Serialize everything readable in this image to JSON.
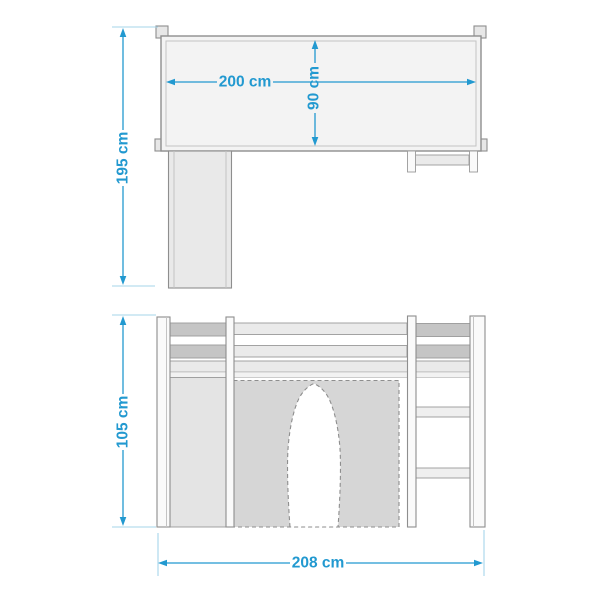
{
  "diagram": {
    "type": "furniture-dimension-drawing",
    "views": {
      "top_view_name": "top-view",
      "front_view_name": "front-view"
    }
  },
  "colors": {
    "dimension_blue": "#2299d0",
    "extension_blue": "#a6d4ea",
    "outline_gray": "#8e8e8e",
    "curtain_gray": "#d6d6d6",
    "rail_dark_gray": "#c5c5c5"
  },
  "top_view": {
    "length": "200 cm",
    "depth": "90 cm",
    "height_total": "195 cm"
  },
  "front_view": {
    "height": "105 cm",
    "width": "208 cm"
  }
}
